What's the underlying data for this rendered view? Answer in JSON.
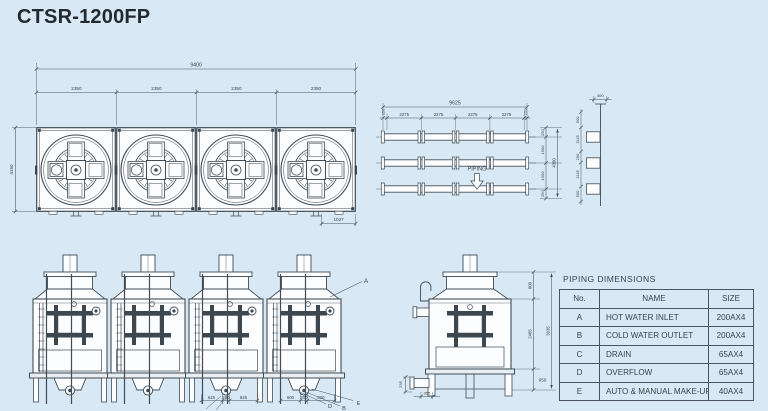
{
  "title": "CTSR-1200FP",
  "colors": {
    "background": "#d8e9f5",
    "line": "#414c55",
    "text": "#39434c"
  },
  "plan_view": {
    "total_width": "9400",
    "bay_widths": [
      "2350",
      "2350",
      "2350",
      "2350"
    ],
    "depth": "4150",
    "offset": "1027"
  },
  "piping_plan": {
    "label": "PIPING",
    "total_length": "9625",
    "end_left": "250",
    "bays": [
      "2275",
      "2275",
      "2275",
      "2275"
    ],
    "end_right": "250",
    "row_spacing": [
      "250",
      "1900",
      "1900",
      "250"
    ],
    "row_total": "4300",
    "riser_spacing": [
      "500",
      "1145",
      "200",
      "1145",
      "500"
    ],
    "riser_width": "400"
  },
  "front_view": {
    "leader_label": "A",
    "anchor_dims_left": [
      "625",
      "200",
      "825"
    ],
    "anchor_dims_right": [
      "600",
      "200",
      "800"
    ],
    "pipe_labels": [
      "D",
      "B",
      "E"
    ]
  },
  "side_view": {
    "top_dim": "800",
    "body_dim": "2485",
    "basin_dim": "650",
    "total_dim": "3935",
    "base_dim": "355",
    "left_dim": "235"
  },
  "piping_table": {
    "title": "PIPING DIMENSIONS",
    "headers": [
      "No.",
      "NAME",
      "SIZE"
    ],
    "rows": [
      {
        "no": "A",
        "name": "HOT WATER INLET",
        "size": "200AX4"
      },
      {
        "no": "B",
        "name": "COLD WATER OUTLET",
        "size": "200AX4"
      },
      {
        "no": "C",
        "name": "DRAIN",
        "size": "65AX4"
      },
      {
        "no": "D",
        "name": "OVERFLOW",
        "size": "65AX4"
      },
      {
        "no": "E",
        "name": "AUTO & MANUAL MAKE-UP",
        "size": "40AX4"
      }
    ]
  }
}
